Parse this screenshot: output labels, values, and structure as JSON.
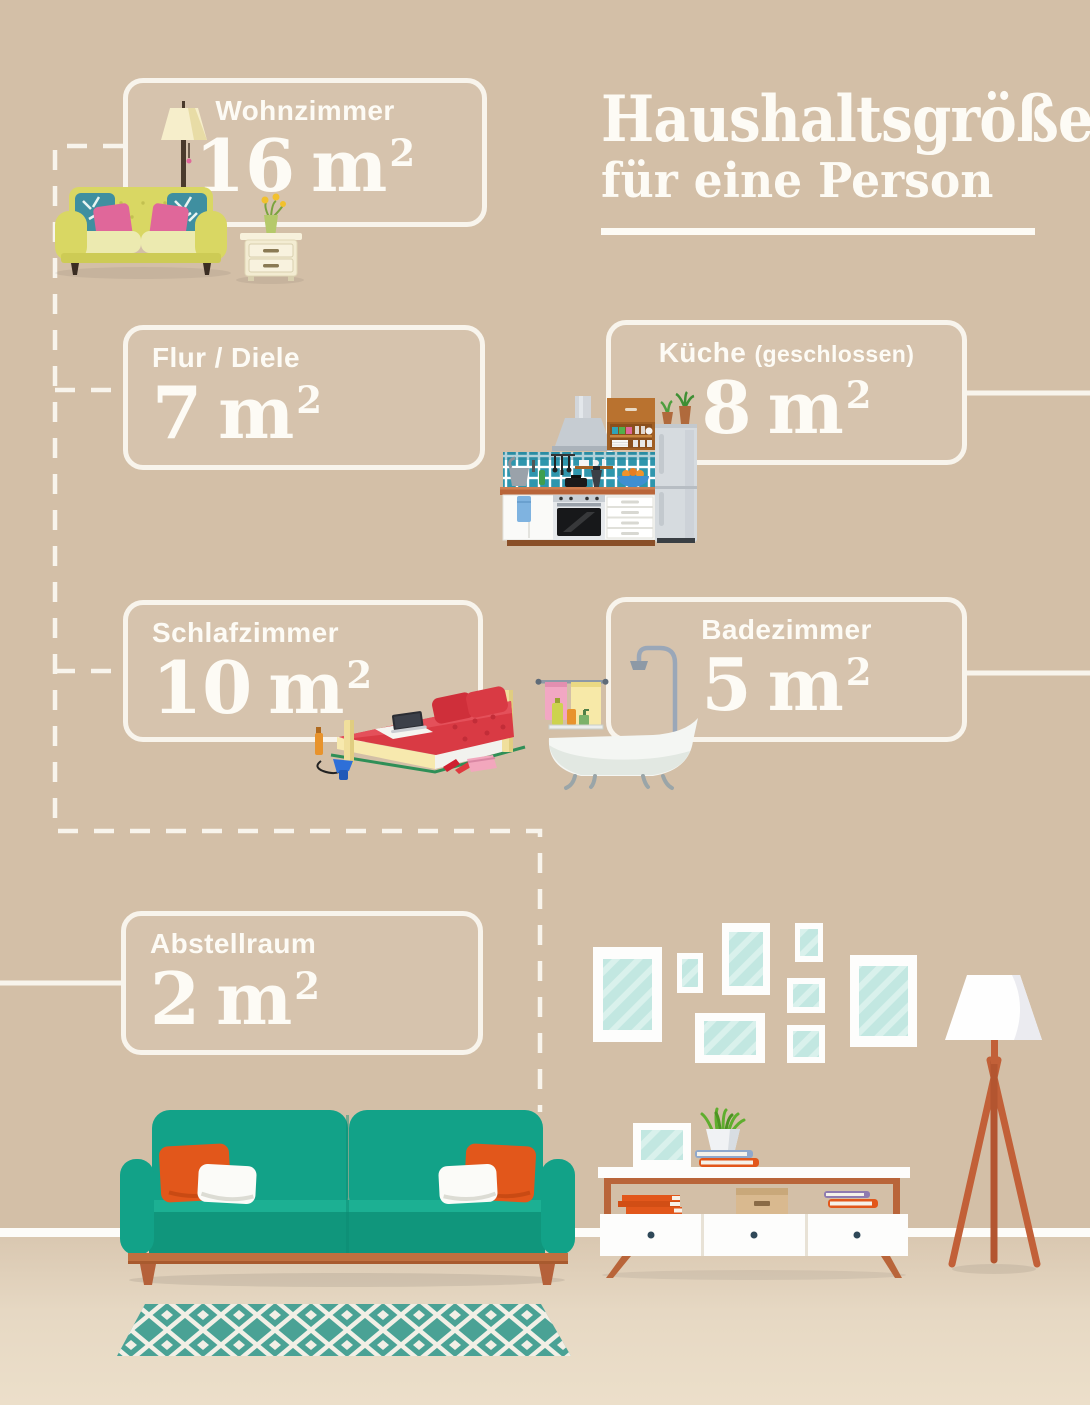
{
  "title": {
    "line1": "Haushaltsgröße",
    "line2": "für eine Person"
  },
  "rooms": [
    {
      "label": "Wohnzimmer",
      "value": "16",
      "unit": "m",
      "sup": "2"
    },
    {
      "label": "Flur / Diele",
      "value": "7",
      "unit": "m",
      "sup": "2"
    },
    {
      "label": "Küche",
      "suffix": "(geschlossen)",
      "value": "8",
      "unit": "m",
      "sup": "2"
    },
    {
      "label": "Schlafzimmer",
      "value": "10",
      "unit": "m",
      "sup": "2"
    },
    {
      "label": "Badezimmer",
      "value": "5",
      "unit": "m",
      "sup": "2"
    },
    {
      "label": "Abstellraum",
      "value": "2",
      "unit": "m",
      "sup": "2"
    }
  ],
  "colors": {
    "wall": "#d3bfa7",
    "floor": "#e6d8c3",
    "line_white": "#f8f4ec",
    "teal_sofa": "#12a288",
    "orange_pillow": "#e2571b",
    "wood": "#c0703f",
    "frame_glass": "#c2e7e1",
    "tile_teal": "#2f96ad",
    "bed_red": "#d93a44",
    "yellow_sofa": "#d9d763"
  },
  "illustrations": [
    "living-room-sofa-icon",
    "kitchen-icon",
    "bed-icon",
    "bathtub-icon",
    "picture-frames-icon",
    "floor-lamp-icon",
    "tv-stand-icon",
    "teal-sofa-icon",
    "rug-icon"
  ]
}
